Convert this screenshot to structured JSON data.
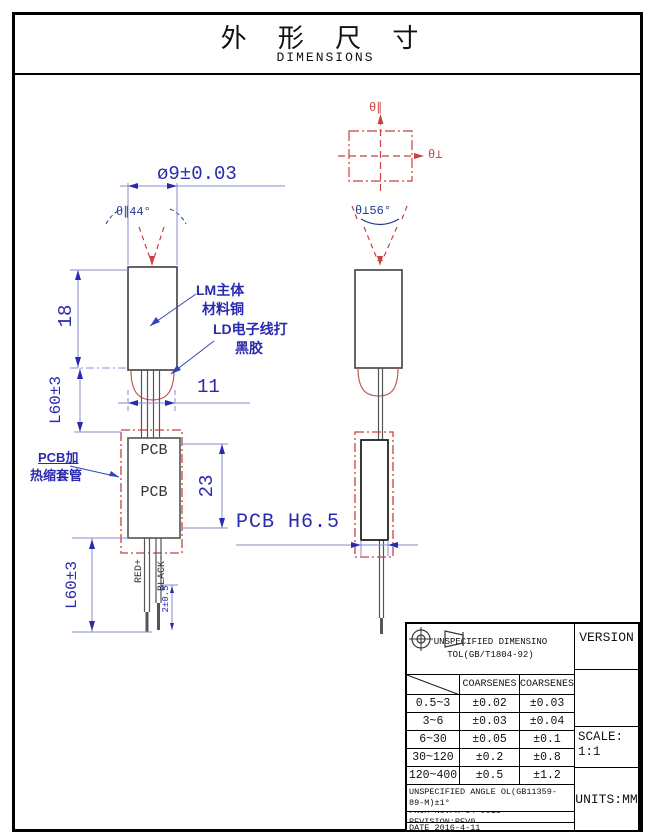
{
  "title": {
    "cn": "外 形 尺 寸",
    "en": "DIMENSIONS"
  },
  "front_view": {
    "dim_diameter": "ø9±0.03",
    "angle_label": "θ∥44°",
    "body_label_line1": "LM主体",
    "body_label_line2": "材料铜",
    "glue_label_line1": "LD电子线打",
    "glue_label_line2": "黑胶",
    "dim_body_height": "18",
    "dim_lead_upper": "L60±3",
    "dim_width": "11",
    "pcb_text_top": "PCB",
    "pcb_text_bottom": "PCB",
    "dim_pcb_height": "23",
    "sleeve_label_line1": "PCB加",
    "sleeve_label_line2": "热缩套管",
    "dim_lead_lower": "L60±3",
    "wire_positive": "RED+",
    "wire_negative": "BLACK-",
    "dim_wire_tip": "2±0.5"
  },
  "side_view": {
    "axis_parallel": "θ∥",
    "axis_perp": "θ⊥",
    "angle_label": "θ⊥56°",
    "dim_pcb_width": "PCB H6.5"
  },
  "tolerance_table": {
    "header": "UNSPECIFIED DIMENSINO TOL(GB/T1804-92)",
    "col1": "COARSENES",
    "col2": "COARSENES",
    "rows": [
      {
        "range": "0.5~3",
        "tol1": "±0.02",
        "tol2": "±0.03"
      },
      {
        "range": "3~6",
        "tol1": "±0.03",
        "tol2": "±0.04"
      },
      {
        "range": "6~30",
        "tol1": "±0.05",
        "tol2": "±0.1"
      },
      {
        "range": "30~120",
        "tol1": "±0.2",
        "tol2": "±0.8"
      },
      {
        "range": "120~400",
        "tol1": "±0.5",
        "tol2": "±1.2"
      }
    ],
    "angle_note": "UNSPECIFIED ANGLE OL(GB11359-89-M)±1°",
    "doc_note": "FROM NO:FR-04-0013 REVISION:REV0",
    "date_note": "DATE 2016-4-11",
    "version_label": "VERSION",
    "scale_label": "SCALE:1:1",
    "units_label": "UNITS:MM"
  },
  "colors": {
    "dimension_blue": "#2a2ab0",
    "annotation_red": "#c84040",
    "dim_line_purple": "#8a8ace",
    "outline_gray": "#3f3f3f"
  }
}
